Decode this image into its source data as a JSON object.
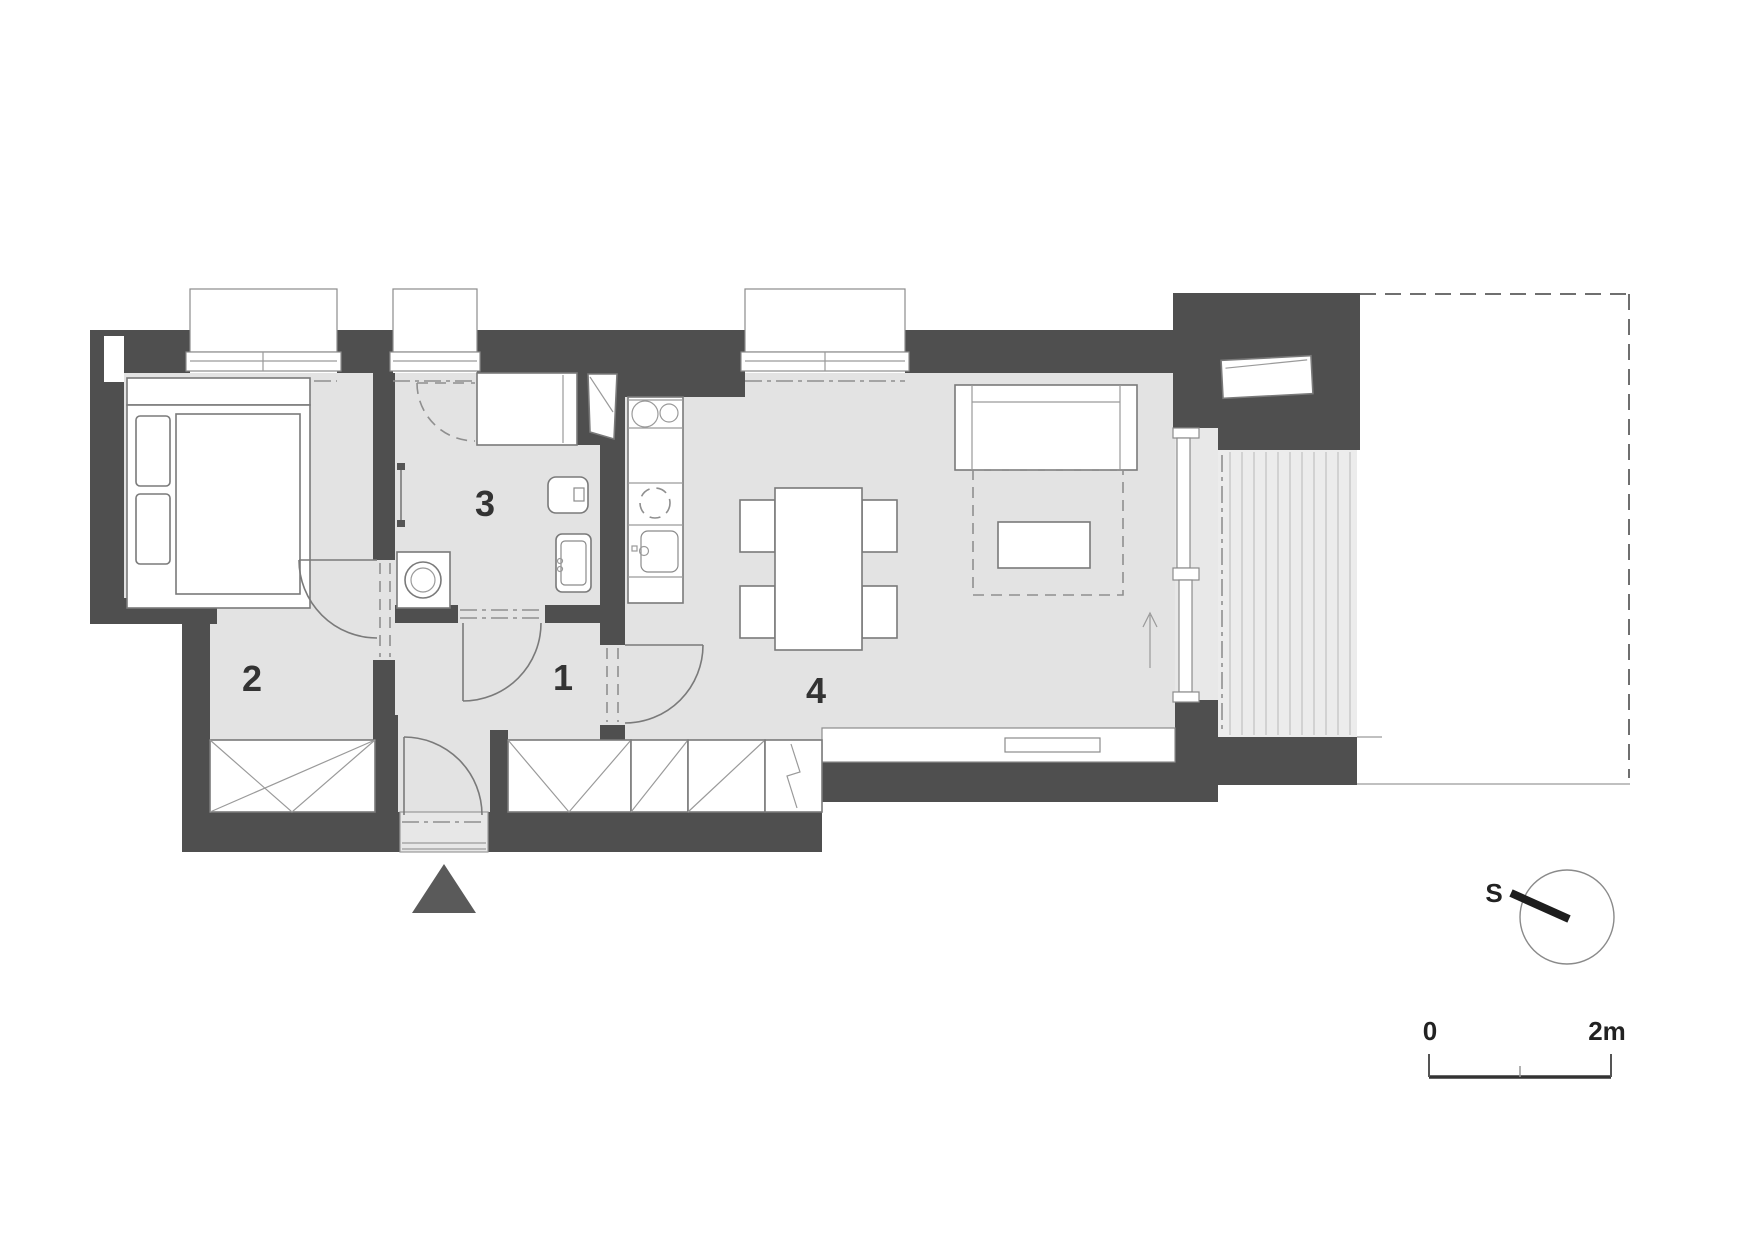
{
  "plan": {
    "room_labels": [
      {
        "id": "bedroom",
        "number": "2"
      },
      {
        "id": "bathroom",
        "number": "3"
      },
      {
        "id": "hallway",
        "number": "1"
      },
      {
        "id": "living-room",
        "number": "4"
      }
    ],
    "compass": {
      "label": "S"
    },
    "scale_bar": {
      "start_label": "0",
      "end_label": "2m"
    },
    "colors": {
      "wall": "#4f4f4f",
      "floor": "#e3e3e3",
      "balcony_deck": "#ececec",
      "furniture_line": "#7a7a7a",
      "background": "#ffffff"
    }
  }
}
